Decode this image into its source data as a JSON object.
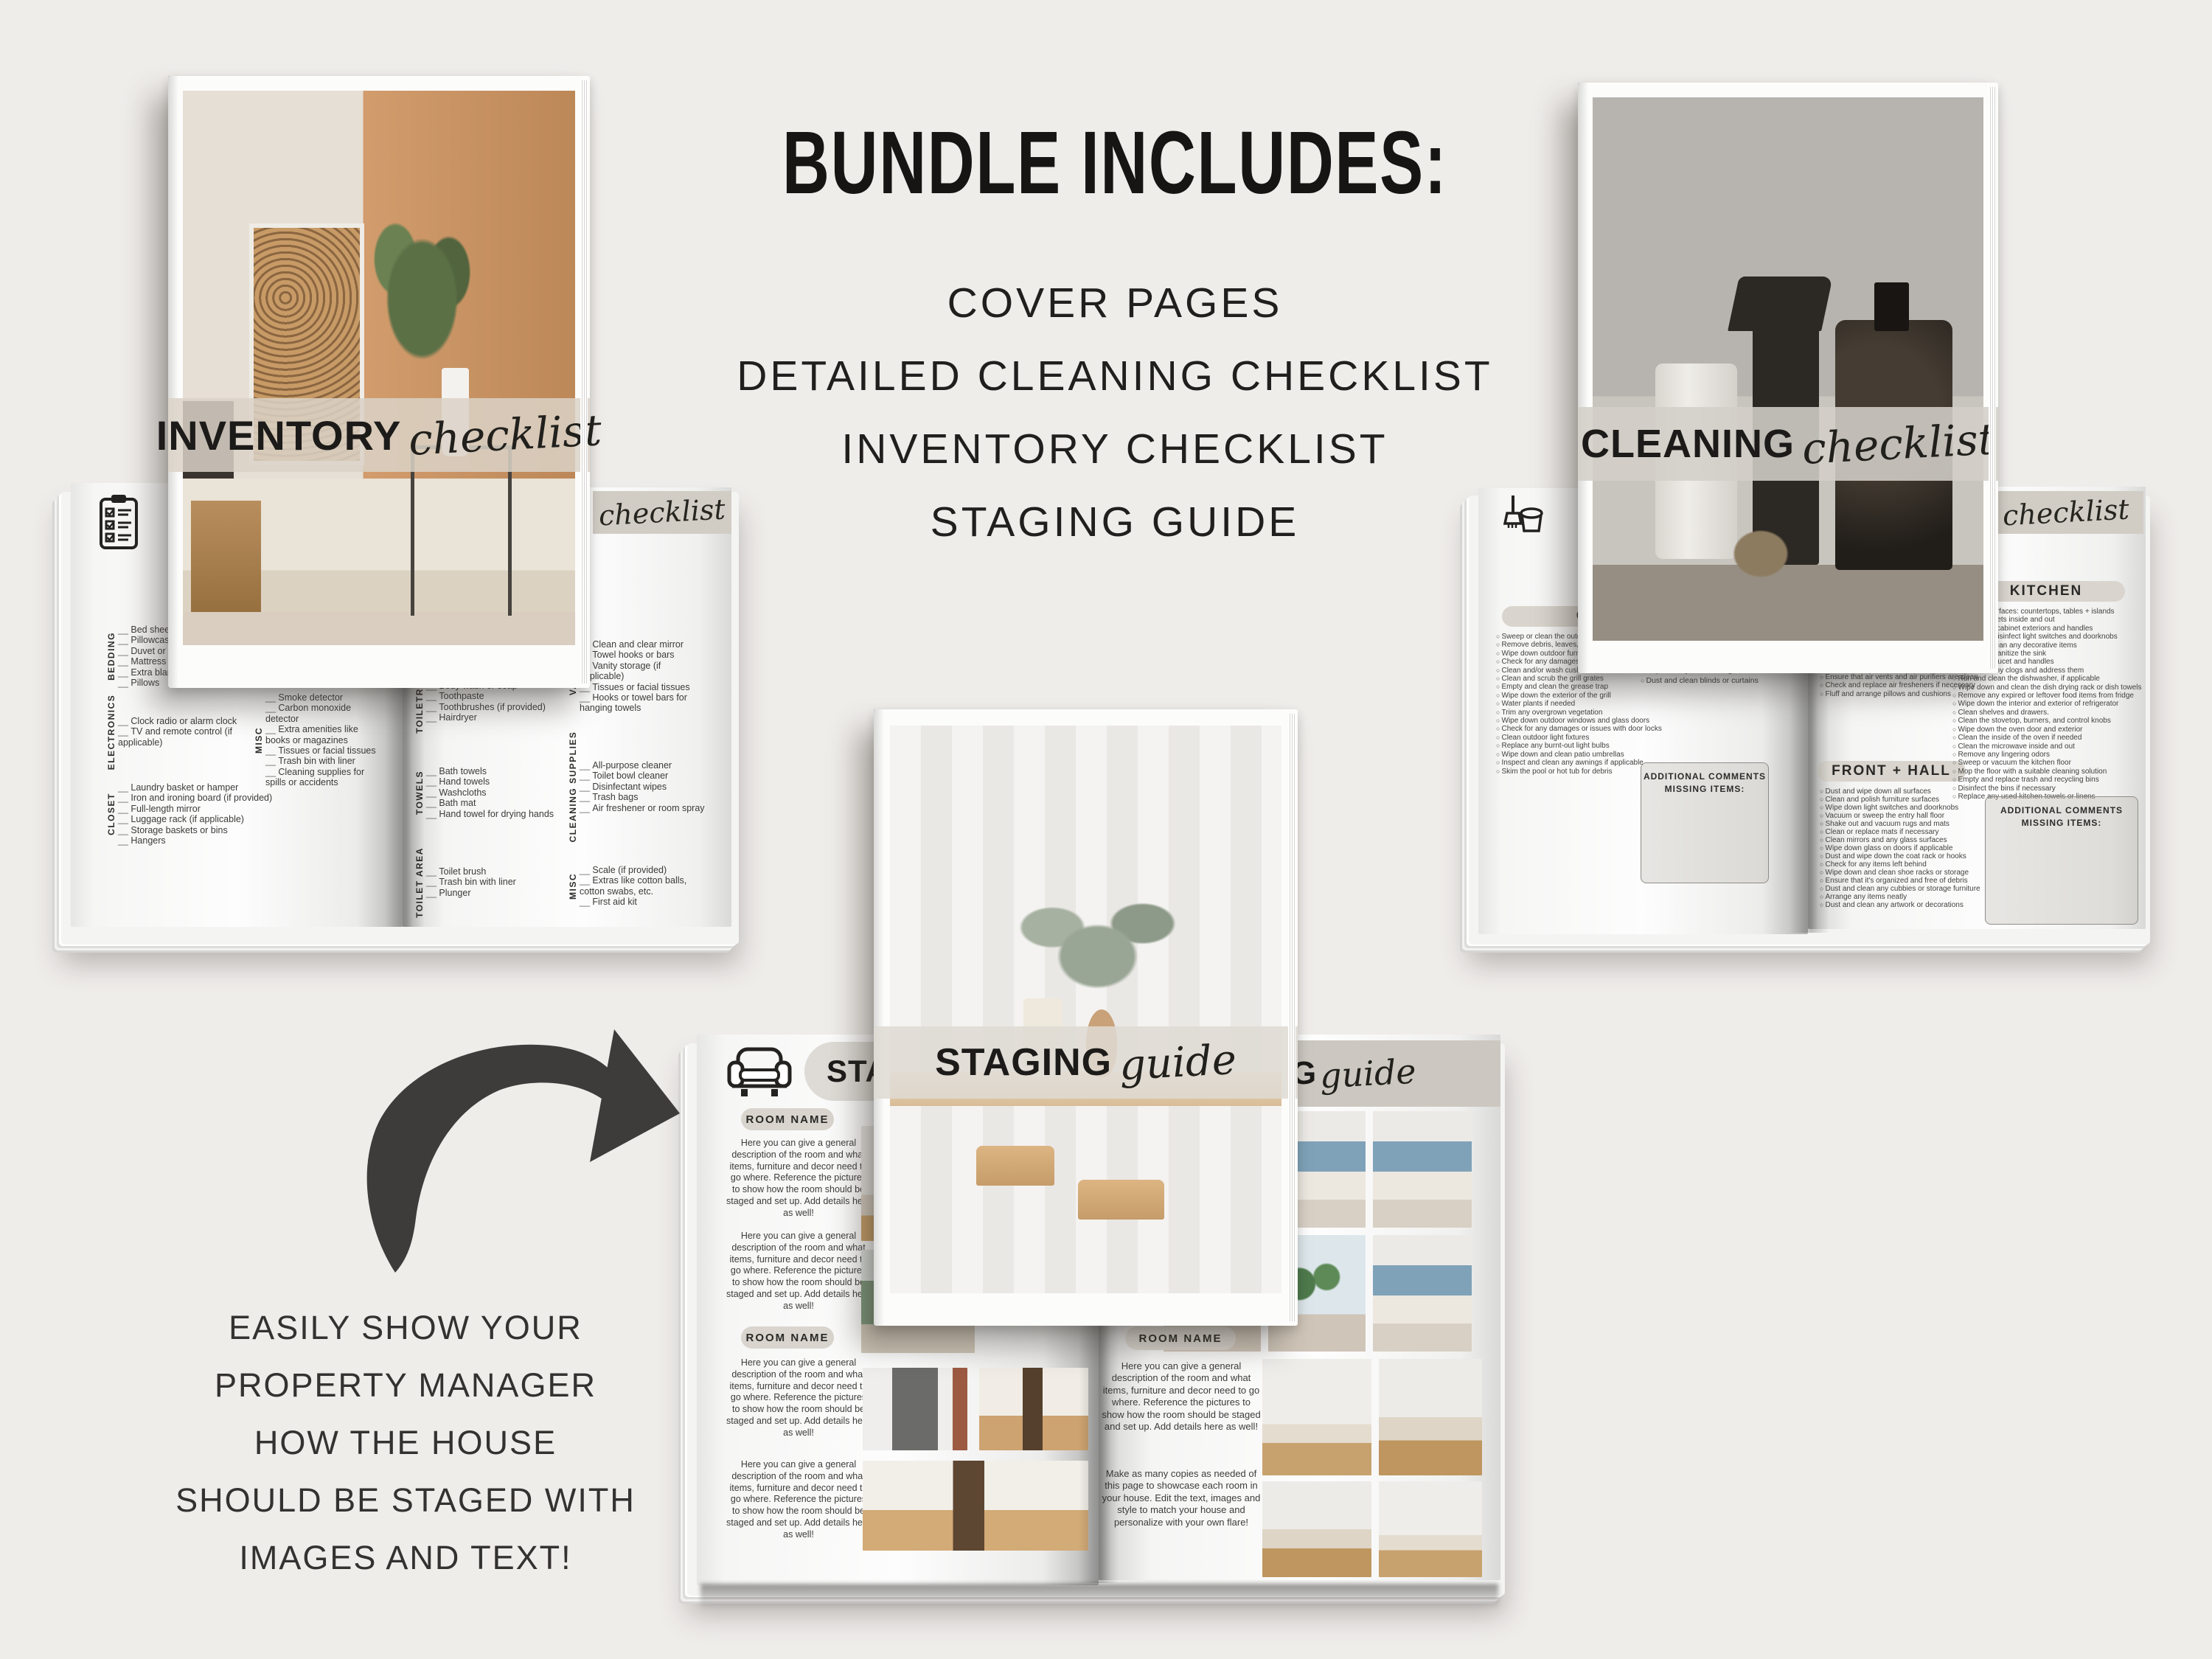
{
  "header": {
    "title": "BUNDLE INCLUDES:",
    "items": [
      "COVER PAGES",
      "DETAILED CLEANING CHECKLIST",
      "INVENTORY CHECKLIST",
      "STAGING GUIDE"
    ]
  },
  "promo": {
    "lines": [
      "EASILY SHOW YOUR",
      "PROPERTY MANAGER",
      "HOW THE HOUSE",
      "SHOULD BE STAGED WITH",
      "IMAGES AND TEXT!"
    ]
  },
  "covers": {
    "inventory": {
      "bold": "INVENTORY",
      "script": "checklist"
    },
    "cleaning": {
      "bold": "CLEANING",
      "script": "checklist"
    },
    "staging": {
      "bold": "STAGING",
      "script": "guide"
    }
  },
  "inventory": {
    "band_script": "checklist",
    "left": {
      "bedding": {
        "label": "BEDDING",
        "items": [
          "Bed sheets",
          "Pillowcases",
          "Duvet or comforter",
          "Mattress protector",
          "Extra blankets",
          "Pillows"
        ]
      },
      "electronics": {
        "label": "ELECTRONICS",
        "items": [
          "Clock radio or alarm clock",
          "TV and remote control (if applicable)"
        ]
      },
      "closet": {
        "label": "CLOSET",
        "items": [
          "Laundry basket or hamper",
          "Iron and ironing board (if provided)",
          "Full-length mirror",
          "Luggage rack (if applicable)",
          "Storage baskets or bins",
          "Hangers"
        ]
      },
      "misc": {
        "label": "MISC",
        "items": [
          "Smoke detector",
          "Carbon monoxide detector",
          "Extra amenities like books or magazines",
          "Tissues or facial tissues",
          "Trash bin with liner",
          "Cleaning supplies for spills or accidents"
        ]
      }
    },
    "right": {
      "toiletries": {
        "label": "TOILETRIES",
        "items": [
          "Body wash or soap",
          "Toothpaste",
          "Toothbrushes (if provided)",
          "Hairdryer"
        ]
      },
      "towels": {
        "label": "TOWELS",
        "items": [
          "Bath towels",
          "Hand towels",
          "Washcloths",
          "Bath mat",
          "Hand towel for drying hands"
        ]
      },
      "toilet_area": {
        "label": "TOILET AREA",
        "items": [
          "Toilet brush",
          "Trash bin with liner",
          "Plunger"
        ]
      },
      "vanity": {
        "label": "VANITY",
        "items": [
          "Clean and clear mirror",
          "Towel hooks or bars",
          "Vanity storage (if applicable)",
          "Tissues or facial tissues",
          "Hooks or towel bars for hanging towels"
        ]
      },
      "cleaning_supplies": {
        "label": "CLEANING SUPPLIES",
        "items": [
          "All-purpose cleaner",
          "Toilet bowl cleaner",
          "Disinfectant wipes",
          "Trash bags",
          "Air freshener or room spray"
        ]
      },
      "misc": {
        "label": "MISC",
        "items": [
          "Scale (if provided)",
          "Extras like cotton balls, cotton swabs, etc.",
          "First aid kit"
        ]
      }
    }
  },
  "cleaning": {
    "band_script": "checklist",
    "outside": {
      "label": "OUTSIDE",
      "items": [
        "Sweep or clean the outdoor area",
        "Remove debris, leaves, and dirt",
        "Wipe down outdoor furniture",
        "Check for any damages or wear",
        "Clean and/or wash cushions",
        "Clean and scrub the grill grates",
        "Empty and clean the grease trap",
        "Wipe down the exterior of the grill",
        "Water plants if needed",
        "Trim any overgrown vegetation",
        "Wipe down outdoor windows and glass doors",
        "Check for any damages or issues with door locks",
        "Clean outdoor light fixtures",
        "Replace any burnt-out light bulbs",
        "Wipe down and clean patio umbrellas",
        "Inspect and clean any awnings if applicable",
        "Skim the pool or hot tub for debris"
      ]
    },
    "left_col2": {
      "items": [
        "Replace any burnt-out light bulbs",
        "Dust and clean blinds or curtains"
      ]
    },
    "comments_line1": "ADDITIONAL COMMENTS",
    "comments_line2": "MISSING ITEMS:",
    "tail": {
      "items": [
        "Replace any burnt-out light bulbs",
        "Clean and dust any decorative items",
        "Ensure that air vents and air purifiers are clean",
        "Check and replace air fresheners if necessary",
        "Fluff and arrange pillows and cushions"
      ]
    },
    "front_hall": {
      "label": "FRONT + HALL",
      "items": [
        "Dust and wipe down all surfaces",
        "Clean and polish furniture surfaces",
        "Wipe down light switches and doorknobs",
        "Vacuum or sweep the entry hall floor",
        "Shake out and vacuum rugs and mats",
        "Clean or replace mats if necessary",
        "Clean mirrors and any glass surfaces",
        "Wipe down glass on doors if applicable",
        "Dust and wipe down the coat rack or hooks",
        "Check for any items left behind",
        "Wipe down and clean shoe racks or storage",
        "Ensure that it's organized and free of debris",
        "Dust and clean any cubbies or storage furniture",
        "Arrange any items neatly",
        "Dust and clean any artwork or decorations"
      ]
    },
    "kitchen": {
      "label": "KITCHEN",
      "items": [
        "Clean all surfaces: countertops, tables + islands",
        "Clean cabinets inside and out",
        "Wipe down cabinet exteriors and handles",
        "Clean and disinfect light switches and doorknobs",
        "Dust and clean any decorative items",
        "Clean and sanitize the sink",
        "Clean the faucet and handles",
        "Check for any clogs and address them",
        "Run and clean the dishwasher, if applicable",
        "Wipe down and clean the dish drying rack or dish towels",
        "Remove any expired or leftover food items from fridge",
        "Wipe down the interior and exterior of refrigerator",
        "Clean shelves and drawers.",
        "Clean the stovetop, burners, and control knobs",
        "Wipe down the oven door and exterior",
        "Clean the inside of the oven if needed",
        "Clean the microwave inside and out",
        "Remove any lingering odors",
        "Sweep or vacuum the kitchen floor",
        "Mop the floor with a suitable cleaning solution",
        "Empty and replace trash and recycling bins",
        "Disinfect the bins if necessary",
        "Replace any used kitchen towels or linens"
      ]
    }
  },
  "staging": {
    "header_bold": "STAGING",
    "header_script": "guide",
    "room_label": "ROOM NAME",
    "para": "Here you can give a general description of the room and what items, furniture and decor need to go where. Reference the pictures to show how the room should be staged and set up. Add details here as well!",
    "para_copies": "Make as many copies as needed of this page to showcase each room in your house. Edit the text, images and style to match your house and personalize with your own flare!"
  },
  "icons": {
    "inventory_page": "clipboard-icon",
    "cleaning_page": "broom-bucket-icon",
    "staging_page": "armchair-icon",
    "promo_arrow": "curved-arrow-icon"
  },
  "colors": {
    "background": "#efedea",
    "band_beige": "#d1cdc5",
    "pill_beige": "#d9d5ce",
    "ink": "#161514",
    "checklist_text": "#3c3b39",
    "arrow": "#3e3c3a",
    "bedroom_blue": "#7fa2b8",
    "wood": "#c9a26e"
  }
}
